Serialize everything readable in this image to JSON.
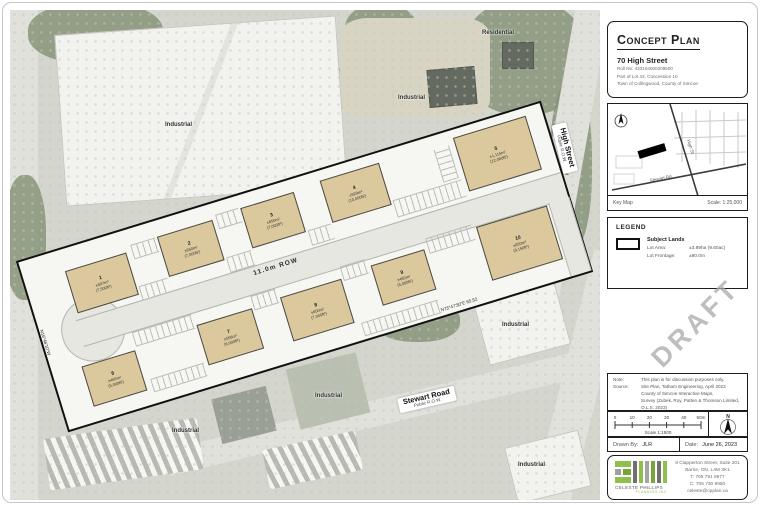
{
  "title_block": {
    "title": "Concept Plan",
    "address": "70 High Street",
    "details": [
      "Roll No: 433104000209500",
      "Part of Lot 43, Concession 10",
      "Town of Collingwood, County of Simcoe"
    ]
  },
  "key_map": {
    "label": "Key Map",
    "scale": "Scale: 1:25,000",
    "streets": {
      "high": "High St",
      "stewart": "Stewart Rd"
    }
  },
  "legend": {
    "heading": "LEGEND",
    "subject_lands": "Subject Lands",
    "lot_area_label": "Lot Area:",
    "lot_area_value": "±3.89ha (9.60ac)",
    "lot_frontage_label": "Lot Frontage:",
    "lot_frontage_value": "±80.0m"
  },
  "notes": {
    "note_label": "Note:",
    "note_text": "This plan is for discussion purposes only.",
    "source_label": "Source:",
    "source_lines": [
      "Site Plan, Tatham Engineering, April 2023",
      "County of Simcoe Interactive Maps,",
      "Survey (Zubek, Roy, Patten & Thomson Limited,",
      "O.L.S. 2023)"
    ]
  },
  "scale_bar": {
    "ticks": [
      "0",
      "10",
      "20",
      "30",
      "40",
      "50m"
    ],
    "scale_text": "Scale 1:1500",
    "north_label": "N"
  },
  "footer": {
    "drawn_by_label": "Drawn By:",
    "drawn_by": "JLR",
    "date_label": "Date:",
    "date": "June 26, 2023"
  },
  "firm": {
    "name": "CELESTE PHILLIPS",
    "sub_name": "PLANNING INC",
    "address_lines": [
      "8 Clapperton Street, Suite 201",
      "Barrie, ON, L4M 3K1",
      "T: 705 791 8977",
      "C: 705 730 9850",
      "celeste@cpplan.ca"
    ],
    "accent_green": "#8fbf4d"
  },
  "plan": {
    "row_label": "11.0m ROW",
    "draft": "DRAFT",
    "buildings": [
      {
        "num": "1",
        "area": "±697m²",
        "sqft": "(7,500ft²)"
      },
      {
        "num": "2",
        "area": "±650m²",
        "sqft": "(7,000ft²)"
      },
      {
        "num": "3",
        "area": "±650m²",
        "sqft": "(7,000ft²)"
      },
      {
        "num": "4",
        "area": "±929m²",
        "sqft": "(10,000ft²)"
      },
      {
        "num": "5",
        "area": "±1,115m²",
        "sqft": "(12,000ft²)"
      },
      {
        "num": "6",
        "area": "±465m²",
        "sqft": "(5,000ft²)"
      },
      {
        "num": "7",
        "area": "±558m²",
        "sqft": "(6,000ft²)"
      },
      {
        "num": "8",
        "area": "±650m²",
        "sqft": "(7,000ft²)"
      },
      {
        "num": "9",
        "area": "±465m²",
        "sqft": "(5,000ft²)"
      },
      {
        "num": "10",
        "area": "±850m²",
        "sqft": "(9,150ft²)"
      }
    ],
    "bearings": {
      "bottom": "N73°47'30\"E  65.52",
      "right": "N16°12'30\"W",
      "left": "N16°46'10\"W"
    }
  },
  "aerial": {
    "industrial_label": "Industrial",
    "residential_label": "Residential",
    "high_street": {
      "name": "High Street",
      "sub": "Public R.O.W."
    },
    "stewart_road": {
      "name": "Stewart Road",
      "sub": "Public R.O.W."
    }
  }
}
